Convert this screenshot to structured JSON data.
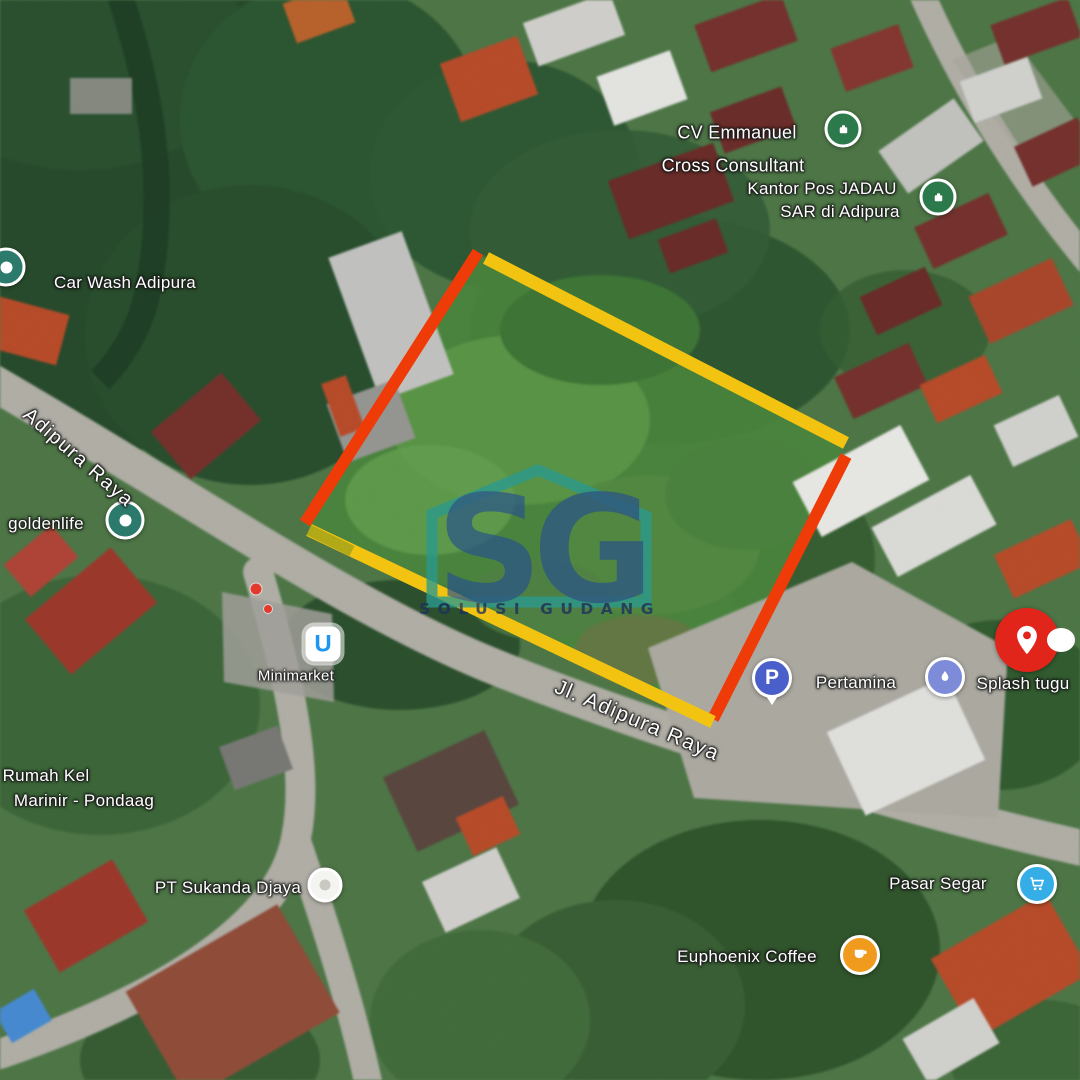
{
  "watermark": {
    "initials": "SG",
    "name": "SOLUSI GUDANG",
    "teal": "#2a9a8f",
    "navy": "#27508f"
  },
  "roads": {
    "adipura_raya": "Adipura Raya",
    "jl_adipura_raya": "Jl. Adipura Raya"
  },
  "places": {
    "car_wash": "Car Wash Adipura",
    "cv_emmanuel": {
      "line1": "CV Emmanuel",
      "line2": "Cross Consultant"
    },
    "kantor_pos": {
      "line1": "Kantor Pos JADAU",
      "line2": "SAR di Adipura"
    },
    "goldenlife": "goldenlife",
    "minimarket": "Minimarket",
    "pertamina": "Pertamina",
    "splash_tugu": "Splash tugu",
    "rumah_kel": {
      "line1": "Rumah Kel",
      "line2": "Marinir - Pondaag"
    },
    "pt_sukanda": "PT Sukanda Djaya",
    "euphoenix": "Euphoenix Coffee",
    "pasar_segar": "Pasar Segar"
  },
  "markers": {
    "pertamina_glyph": "P",
    "minimarket_glyph": "U"
  },
  "overlay": {
    "boundary_red": "#ee3b07",
    "boundary_yellow": "#f2c411",
    "highlight_pin_red": "#e1251b"
  }
}
